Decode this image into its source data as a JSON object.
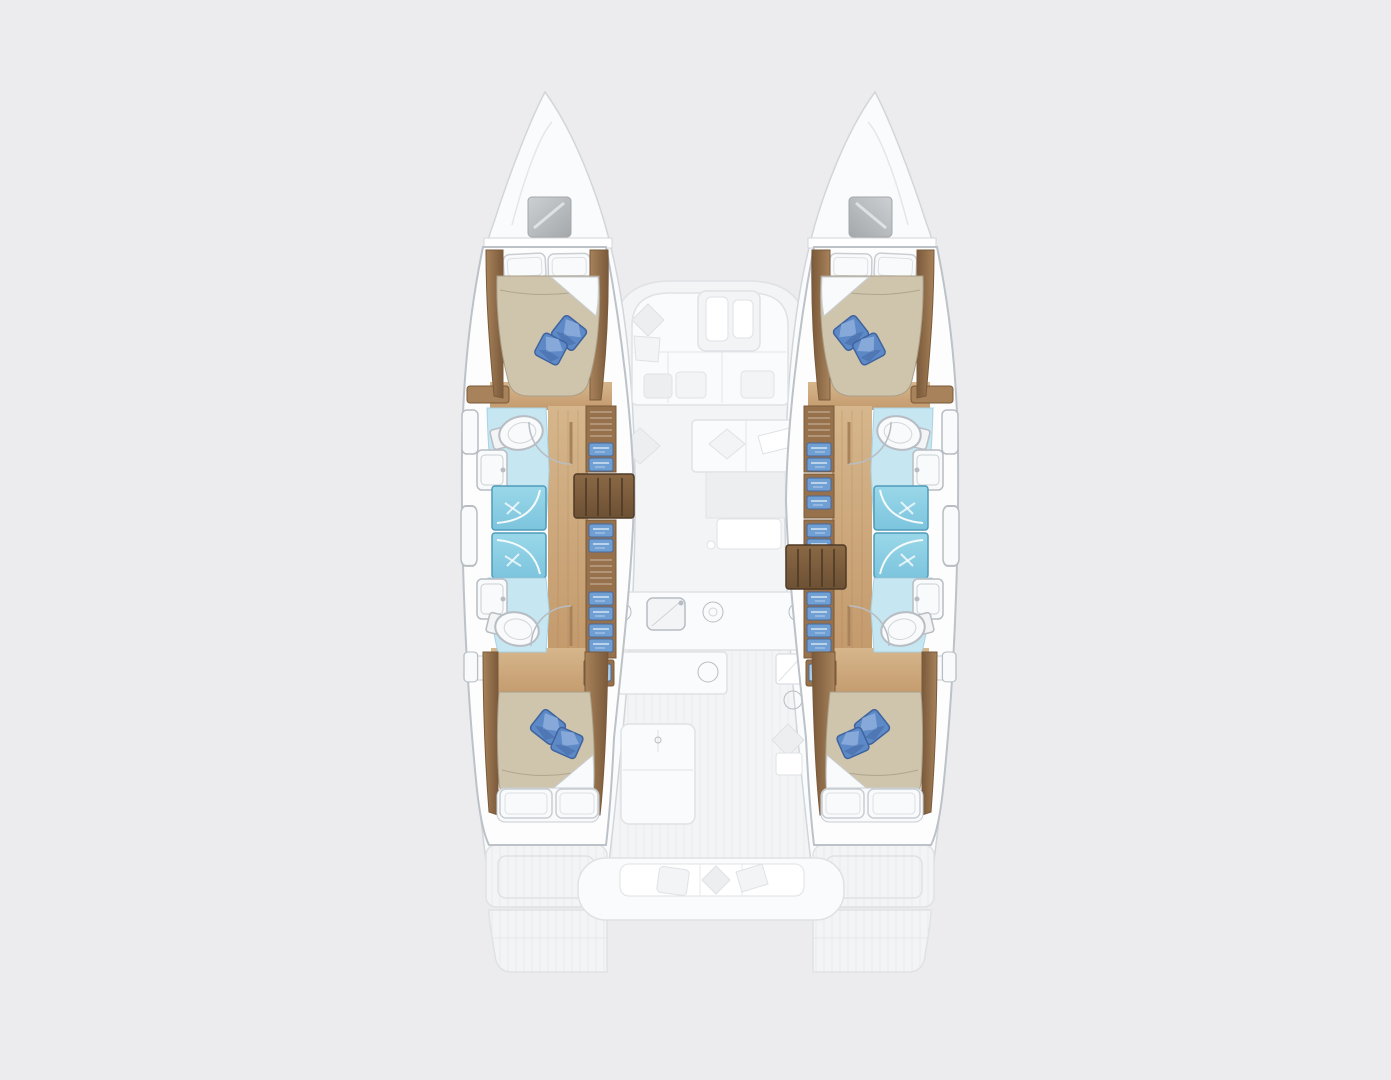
{
  "image": {
    "kind": "catamaran floor plan, overhead view",
    "rendering": "hull interiors in color, deck / saloon / cockpit ghosted in pale grey",
    "width": 1391,
    "height": 1080
  },
  "palette": {
    "background": "#ececee",
    "hull_fill": "#fdfdfe",
    "hull_stroke": "#bcc2c8",
    "ghost_white": "#fafbfc",
    "ghost_fill": "#f3f4f6",
    "ghost_fill_dark": "#eceef0",
    "ghost_stroke": "#dfe2e5",
    "plank_line": "#e4e6e8",
    "deck_line": "#d2d6d9",
    "wood_light": "#d6b68c",
    "wood_mid": "#c39a6c",
    "wood_dark": "#97714c",
    "wood_rail": "#a8825a",
    "wood_edge": "#7a5a3b",
    "stair_top": "#8a6845",
    "stair_bottom": "#6d5134",
    "stair_line": "#4e3a26",
    "quilt": "#cfc4ac",
    "quilt_shadow": "#a99e88",
    "linen": "#f9fafb",
    "linen_stroke": "#c9ced3",
    "pillow_blue": "#5d89c7",
    "pillow_blue_light": "#8badda",
    "pillow_blue_dark": "#3e629d",
    "head_floor": "#c6e6f1",
    "head_floor_stroke": "#a9d2e3",
    "shower_light": "#9ad8e9",
    "shower": "#7cc4dd",
    "shower_stroke": "#4f9cba",
    "drawer_blue": "#6f9fd3",
    "drawer_blue_dark": "#47699e",
    "screen_blue": "#a9cce9",
    "fixture": "#f2f4f5",
    "fixture_stroke": "#b7bdc3",
    "hatch_light": "#cdd0d2",
    "hatch_dark": "#a4a8ab",
    "white": "#ffffff"
  },
  "vessel": {
    "hull_count": 2,
    "cabin_count": 4,
    "head_count": 4,
    "shower_stall_count": 4,
    "hulls": [
      {
        "side": "port (left)",
        "rooms": [
          {
            "name": "forward cabin",
            "features": [
              "double berth",
              "2 white head pillows",
              "beige quilt with folded white corner",
              "2 blue accent pillows",
              "wood side rails"
            ]
          },
          {
            "name": "forward head",
            "features": [
              "toilet",
              "washbasin",
              "door swing arc",
              "pale blue sole"
            ]
          },
          {
            "name": "midship shower stalls",
            "count": 2,
            "features": [
              "blue sole",
              "curved glass door"
            ]
          },
          {
            "name": "aft head",
            "features": [
              "toilet",
              "washbasin",
              "door swing arc",
              "pale blue sole"
            ]
          },
          {
            "name": "corridor",
            "floor": "teak wood"
          },
          {
            "name": "inboard wardrobes",
            "features": [
              "louvre vents",
              "blue drawer fronts"
            ]
          },
          {
            "name": "companionway stairs",
            "steps": 4,
            "position": "forward of midships"
          },
          {
            "name": "aft cabin",
            "features": [
              "double berth",
              "2 blue accent pillows",
              "folded white corner",
              "2 white foot pillows",
              "blue screen on inboard cabinet"
            ]
          }
        ]
      },
      {
        "side": "starboard (right)",
        "layout": "mirror image of port hull",
        "difference": "companionway stairs located further aft"
      }
    ],
    "ghosted_deck": [
      "2 pointed bows with grey deck hatches",
      "saloon with U-shaped sofa, coffee table and scatter cushions",
      "chaise seat with cushions",
      "chart table",
      "galley with sink, burners and fridge",
      "cockpit table",
      "transom bench with cushions",
      "2 swim platforms with plank texture"
    ]
  }
}
